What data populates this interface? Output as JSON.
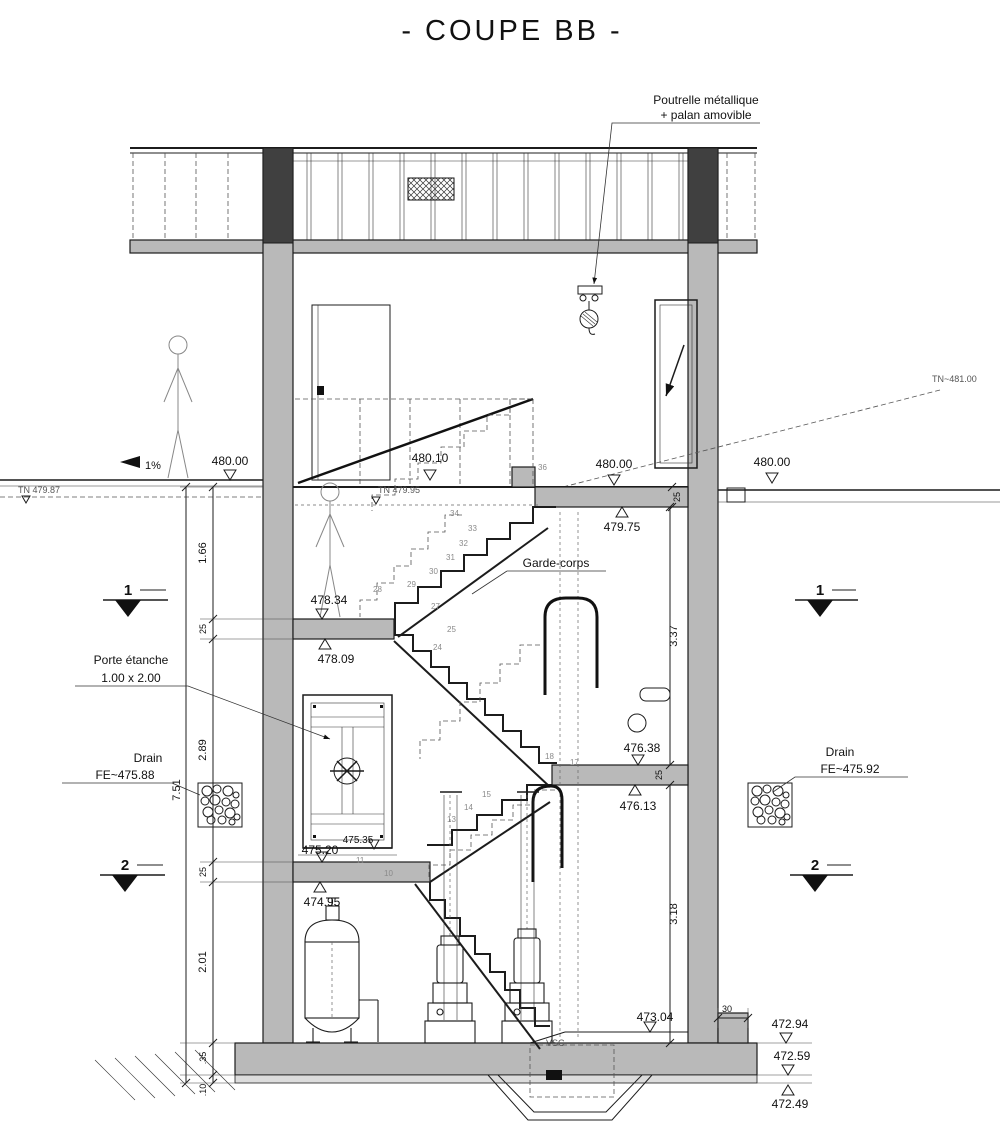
{
  "title": "- COUPE BB -",
  "labels": {
    "poutrelle1": "Poutrelle métallique",
    "poutrelle2": "+ palan amovible",
    "garde": "Garde-corps",
    "porte1": "Porte étanche",
    "porte2": "1.00 x 2.00",
    "drain_l1": "Drain",
    "drain_l2": "FE~475.88",
    "drain_r1": "Drain",
    "drain_r2": "FE~475.92",
    "tn_left": "TN 479.87",
    "tn_mid": "TN 479.95",
    "tn_right": "TN~481.00",
    "slope": "1%",
    "vsc": "VSC"
  },
  "levels": {
    "ext_left": "480.00",
    "mid": "480.10",
    "int_right": "480.00",
    "ext_right": "480.00",
    "l47975": "479.75",
    "l47834": "478.34",
    "l47809": "478.09",
    "l47638": "476.38",
    "l47613": "476.13",
    "l47520": "475.20",
    "l47535": "475.35",
    "l47495": "474.95",
    "l47304": "473.04",
    "l47294": "472.94",
    "l47259": "472.59",
    "l47249": "472.49"
  },
  "dims": {
    "h166": "1.66",
    "t25a": "25",
    "h289": "2.89",
    "t25b": "25",
    "h201": "2.01",
    "h35": ".35",
    "h10": ".10",
    "total": "7.51",
    "r337": "3.37",
    "r318": "3.18",
    "r25a": "25",
    "r25b": "25",
    "w30": "30"
  },
  "sections": {
    "one": "1",
    "two": "2"
  },
  "stairs": {
    "nums": [
      "36",
      "34",
      "33",
      "32",
      "31",
      "30",
      "29",
      "28",
      "27",
      "25",
      "24",
      "18",
      "17",
      "15",
      "14",
      "13",
      "11",
      "10"
    ]
  }
}
